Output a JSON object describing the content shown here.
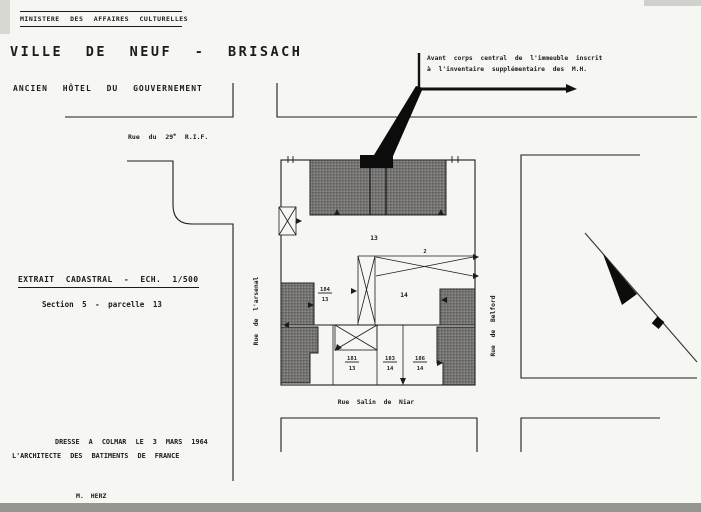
{
  "header": {
    "ministry": "MINISTERE DES AFFAIRES CULTURELLES",
    "city_title": "VILLE DE NEUF - BRISACH",
    "building_title": "ANCIEN HÔTEL DU GOUVERNEMENT"
  },
  "annotation": {
    "line1": "Avant corps central de l'immeuble inscrit",
    "line2": "à l'inventaire supplémentaire des M.H."
  },
  "extract": {
    "title": "EXTRAIT CADASTRAL - ECH. 1/500",
    "subtitle": "Section 5 - parcelle 13"
  },
  "footer": {
    "date_line": "DRESSE A COLMAR LE 3 MARS 1964",
    "author_line": "L'ARCHITECTE DES BATIMENTS DE FRANCE",
    "signature": "M. HERZ"
  },
  "map": {
    "street_north_part1": "Rue du 29",
    "street_north_sup": "e",
    "street_north_part2": " R.I.F.",
    "street_west": "Rue de l'arsenal",
    "street_east": "Rue de Belford",
    "street_south": "Rue Salin de Niar",
    "parcel_13": "13",
    "parcel_14": "14",
    "dim_2": "2",
    "fractions": [
      {
        "num": "184",
        "den": "13"
      },
      {
        "num": "181",
        "den": "13"
      },
      {
        "num": "183",
        "den": "14"
      },
      {
        "num": "186",
        "den": "14"
      }
    ],
    "ink_color": "#1c1c1c",
    "building_fill": "#6e6e6e"
  }
}
